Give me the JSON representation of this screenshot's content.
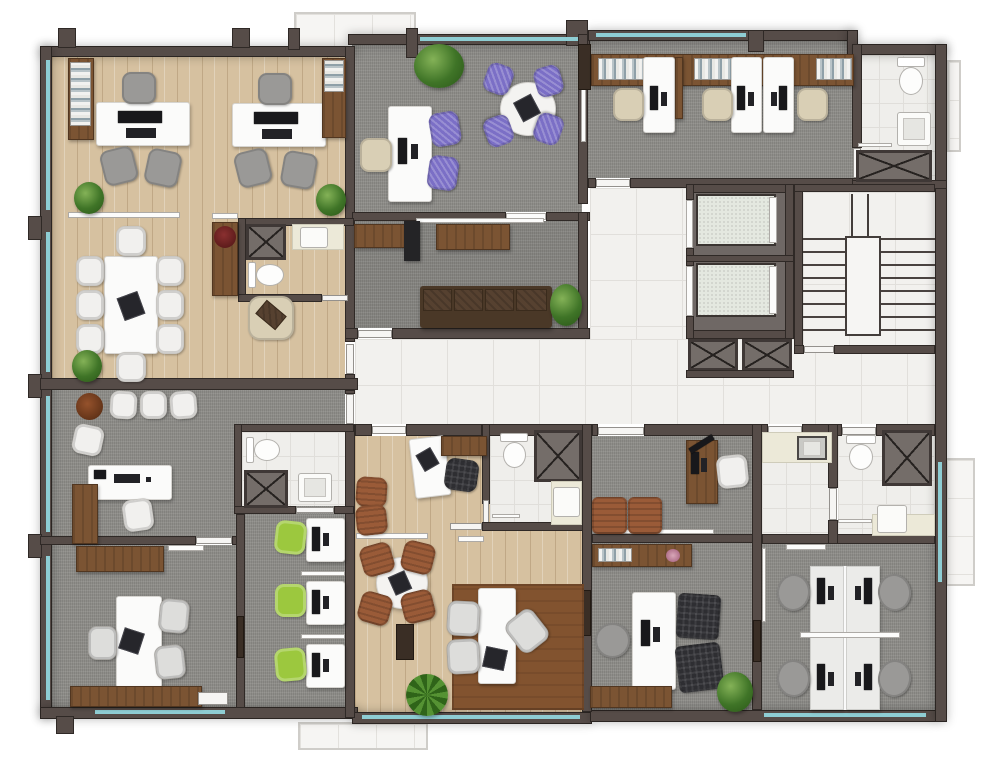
{
  "meta": {
    "view": "top-down 3d office floor plan rendering",
    "canvas": {
      "width": 1000,
      "height": 767
    },
    "visible_text": "none"
  },
  "palette": {
    "wall": "#564c48",
    "window_glass": "#8ecdd3",
    "wood": "#d6c1a0",
    "carpet": "#8e8d89",
    "tile": "#f2f1ee",
    "bath_tile": "#efeeeb",
    "desk_white": "#fbfbfa",
    "wood_brown": "#7b5433",
    "sofa_brown": "#4a3827",
    "chair_purple": "#7b6fc6",
    "chair_green": "#9cc83e",
    "chair_beige": "#d9cfb5",
    "chair_gray": "#9a9997",
    "chair_black": "#2e2e32",
    "leather_sienna": "#9a5b38",
    "rug_brown": "#82532f",
    "elevator_cab": "#e4e8e0",
    "plant_green": "#3f7427"
  },
  "rooms": [
    {
      "id": "executive-office",
      "floor": "wood plank",
      "contents": [
        "2 white desks with computers",
        "2 gray executive chairs",
        "4 gray guest chairs",
        "2 binder shelves",
        "2 corner plants"
      ]
    },
    {
      "id": "conference-room",
      "floor": "wood plank",
      "contents": [
        "8-seat white conference table",
        "laptop",
        "beige lounge chair",
        "brown cabinet with red plant",
        "corner plant"
      ]
    },
    {
      "id": "conference-wc",
      "floor": "ceramic tile",
      "contents": [
        "toilet",
        "sink counter",
        "service shaft"
      ]
    },
    {
      "id": "purple-meeting-room",
      "floor": "gray carpet",
      "contents": [
        "round table with laptop",
        "4 purple chairs",
        "desk with monitor",
        "beige task chair",
        "2 purple guest chairs",
        "shrub"
      ]
    },
    {
      "id": "reception",
      "floor": "gray carpet",
      "contents": [
        "wall-hung reception counter",
        "low cabinet",
        "black locker",
        "4-seat brown tufted sofa",
        "plant"
      ]
    },
    {
      "id": "open-office-north",
      "floor": "gray carpet",
      "contents": [
        "credenza with binders",
        "3 white workstation desks",
        "3 beige task chairs",
        "3 monitors"
      ]
    },
    {
      "id": "wc-north-east",
      "floor": "ceramic tile",
      "contents": [
        "toilet",
        "sink",
        "service shaft",
        "towel bar"
      ]
    },
    {
      "id": "elevator-core",
      "contents": [
        "2 elevator cabins",
        "2 service shafts below"
      ]
    },
    {
      "id": "stairwell",
      "contents": [
        "two stair flights",
        "central landing",
        "railings"
      ]
    },
    {
      "id": "corridor-lobby",
      "floor": "white tile",
      "contents": [
        "door leaves"
      ]
    },
    {
      "id": "office-west-upper",
      "floor": "gray carpet",
      "contents": [
        "desk with keyboard and phone",
        "brown cabinet",
        "4 white chairs",
        "planter pot"
      ]
    },
    {
      "id": "wc-west",
      "floor": "ceramic tile",
      "contents": [
        "toilet",
        "sink",
        "service shaft"
      ]
    },
    {
      "id": "meeting-room-west",
      "floor": "gray carpet",
      "contents": [
        "white table with laptop",
        "3 silver chairs",
        "brown credenza",
        "brown sideboard",
        "whiteboard",
        "white door"
      ]
    },
    {
      "id": "workstation-row-west",
      "floor": "gray carpet",
      "contents": [
        "3 white desks with monitors",
        "3 green chairs",
        "2 divider screens"
      ]
    },
    {
      "id": "studio-suite-south",
      "floor": "wood plank",
      "contents": [
        "angled corner desk with laptop",
        "black chair",
        "brown cabinet",
        "2 sienna guest chairs",
        "round table with laptop",
        "4 sienna chairs",
        "desk with laptop",
        "2 silver chairs",
        "1 angled silver chair",
        "brown area rug",
        "dark cabinet",
        "palm plant"
      ]
    },
    {
      "id": "studio-wc",
      "floor": "ceramic tile",
      "contents": [
        "toilet",
        "sink counter",
        "service shaft",
        "grab bar"
      ]
    },
    {
      "id": "manager-office-east",
      "floor": "gray carpet",
      "contents": [
        "brown desk with monitor",
        "desk lamp",
        "white chair",
        "2 sienna armchairs",
        "whiteboard",
        "sideboard with books and flower"
      ]
    },
    {
      "id": "director-office-east",
      "floor": "gray carpet",
      "contents": [
        "white desk with computer",
        "gray task chair",
        "2 black tufted armchairs",
        "plant",
        "brown credenza"
      ]
    },
    {
      "id": "kitchenette",
      "floor": "white tile",
      "contents": [
        "counter",
        "steel sink"
      ]
    },
    {
      "id": "wc-south-east",
      "floor": "ceramic tile",
      "contents": [
        "toilet",
        "sink counter",
        "service shaft",
        "grab bar"
      ]
    },
    {
      "id": "team-room-east",
      "floor": "gray carpet",
      "contents": [
        "4-person bench desk",
        "4 monitors",
        "4 gray chairs",
        "divider screens",
        "plant"
      ]
    },
    {
      "id": "balcony-north",
      "floor": "light tile"
    },
    {
      "id": "balcony-east",
      "floor": "light tile"
    },
    {
      "id": "balcony-south",
      "floor": "light tile"
    }
  ]
}
